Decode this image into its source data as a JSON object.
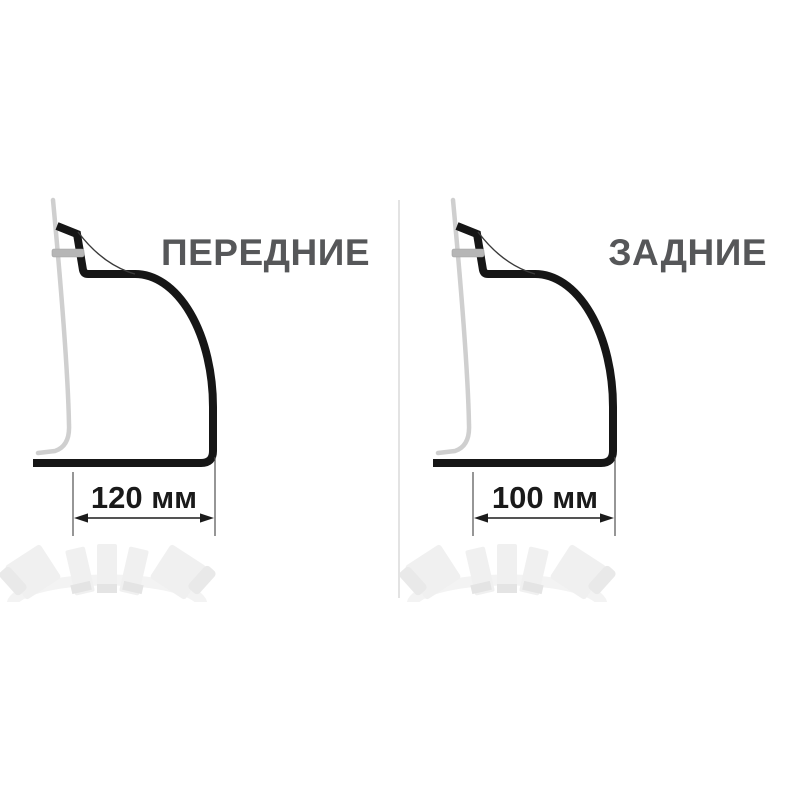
{
  "page": {
    "background": "#ffffff"
  },
  "figures": [
    {
      "id": "front",
      "title": "ПЕРЕДНИЕ",
      "dimension_label": "120 мм",
      "dimension_value_mm": 120,
      "unit": "мм"
    },
    {
      "id": "rear",
      "title": "ЗАДНИЕ",
      "dimension_label": "100 мм",
      "dimension_value_mm": 100,
      "unit": "мм"
    }
  ],
  "colors": {
    "profile_stroke": "#161616",
    "body_panel_stroke": "#cfcfcf",
    "clip_fill": "#b6b6b6",
    "title_text": "#565759",
    "dimension_text": "#1a1a1a",
    "divider": "#e3e3e3",
    "faded_photo": "#f0f0f0"
  }
}
